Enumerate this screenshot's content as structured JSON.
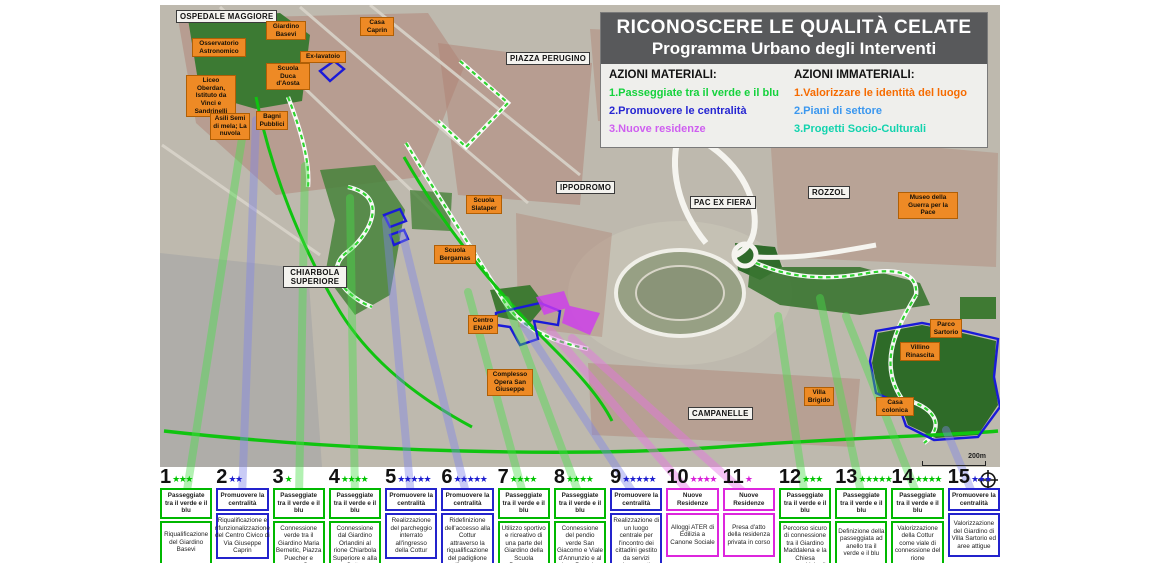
{
  "legend": {
    "title_line1": "RICONOSCERE LE QUALITÀ CELATE",
    "title_line2": "Programma Urbano degli Interventi",
    "materiali_header": "AZIONI MATERIALI:",
    "immateriali_header": "AZIONI IMMATERIALI:",
    "materiali": [
      {
        "label": "1.Passeggiate tra il verde e il blu",
        "color": "#14d23c"
      },
      {
        "label": "2.Promuovere le centralità",
        "color": "#2626d2"
      },
      {
        "label": "3.Nuove residenze",
        "color": "#cf5ff0"
      }
    ],
    "immateriali": [
      {
        "label": "1.Valorizzare le identità del luogo",
        "color": "#f66b00"
      },
      {
        "label": "2.Piani di settore",
        "color": "#3a97ef"
      },
      {
        "label": "3.Progetti Socio-Culturali",
        "color": "#12d3ae"
      }
    ]
  },
  "map": {
    "scale_label": "200m",
    "labels": [
      {
        "text": "OSPEDALE MAGGIORE",
        "kind": "place",
        "x": 176,
        "y": 10
      },
      {
        "text": "Giardino Basevi",
        "kind": "poi",
        "x": 266,
        "y": 21,
        "w": 40
      },
      {
        "text": "Casa Caprin",
        "kind": "poi",
        "x": 360,
        "y": 17,
        "w": 34
      },
      {
        "text": "Osservatorio Astronomico",
        "kind": "poi",
        "x": 192,
        "y": 38,
        "w": 54
      },
      {
        "text": "Ex-lavatoio",
        "kind": "poi",
        "x": 300,
        "y": 51,
        "w": 46
      },
      {
        "text": "Scuola Duca d'Aosta",
        "kind": "poi",
        "x": 266,
        "y": 63,
        "w": 44
      },
      {
        "text": "Liceo Oberdan, Istituto da Vinci e Sandrinelli",
        "kind": "poi",
        "x": 186,
        "y": 75,
        "w": 50
      },
      {
        "text": "Asili Semi di mela; La nuvola",
        "kind": "poi",
        "x": 210,
        "y": 113,
        "w": 40
      },
      {
        "text": "Bagni Pubblici",
        "kind": "poi",
        "x": 256,
        "y": 111,
        "w": 32
      },
      {
        "text": "PIAZZA PERUGINO",
        "kind": "place",
        "x": 506,
        "y": 52
      },
      {
        "text": "IPPODROMO",
        "kind": "place",
        "x": 556,
        "y": 181
      },
      {
        "text": "Scuola Slataper",
        "kind": "poi",
        "x": 466,
        "y": 195,
        "w": 36
      },
      {
        "text": "Scuola Bergamas",
        "kind": "poi",
        "x": 434,
        "y": 245,
        "w": 42
      },
      {
        "text": "CHIARBOLA SUPERIORE",
        "kind": "place",
        "x": 283,
        "y": 266,
        "w": 64
      },
      {
        "text": "PAC EX FIERA",
        "kind": "place",
        "x": 690,
        "y": 196
      },
      {
        "text": "ROZZOL",
        "kind": "place",
        "x": 808,
        "y": 186
      },
      {
        "text": "Museo della Guerra per la Pace",
        "kind": "poi",
        "x": 898,
        "y": 192,
        "w": 60
      },
      {
        "text": "Centro ENAIP",
        "kind": "poi",
        "x": 468,
        "y": 315,
        "w": 30
      },
      {
        "text": "Complesso Opera San Giuseppe",
        "kind": "poi",
        "x": 487,
        "y": 369,
        "w": 46
      },
      {
        "text": "Parco Sartorio",
        "kind": "poi",
        "x": 930,
        "y": 319,
        "w": 32
      },
      {
        "text": "Villino Rinascita",
        "kind": "poi",
        "x": 900,
        "y": 342,
        "w": 40
      },
      {
        "text": "Villa Brigido",
        "kind": "poi",
        "x": 804,
        "y": 387,
        "w": 30
      },
      {
        "text": "Casa colonica",
        "kind": "poi",
        "x": 876,
        "y": 397,
        "w": 38
      },
      {
        "text": "CAMPANELLE",
        "kind": "place",
        "x": 688,
        "y": 407
      }
    ]
  },
  "items": [
    {
      "number": "1",
      "stars": "★★★",
      "type": "green",
      "category": "Passeggiate tra il verde e il blu",
      "description": "Riqualificazione del Giardino Basevi"
    },
    {
      "number": "2",
      "stars": "★★",
      "type": "blue",
      "category": "Promuovere la centralità",
      "description": "Riqualificazione e rifunzionalizzazione del Centro Civico di Via Giuseppe Caprin"
    },
    {
      "number": "3",
      "stars": "★",
      "type": "green",
      "category": "Passeggiate tra il verde e il blu",
      "description": "Connessione verde tra il Giardino Maria Bernetic, Piazza Puecher e campo San Giacomo"
    },
    {
      "number": "4",
      "stars": "★★★★",
      "type": "green",
      "category": "Passeggiate tra il verde e il blu",
      "description": "Connessione dal Giardino Orlandini al rione Chiarbola Superiore e alla Cottur"
    },
    {
      "number": "5",
      "stars": "★★★★★",
      "type": "blue",
      "category": "Promuovere la centralità",
      "description": "Realizzazione del parcheggio interrato all'ingresso della Cottur"
    },
    {
      "number": "6",
      "stars": "★★★★★",
      "type": "blue",
      "category": "Promuovere la centralità",
      "description": "Ridefinizione dell'accesso alla Cottur attraverso la riqualificazione del padiglione d'ingresso"
    },
    {
      "number": "7",
      "stars": "★★★★",
      "type": "green",
      "category": "Passeggiate tra il verde e il blu",
      "description": "Utilizzo sportivo e ricreativo di una parte del Giardino della Scuola Bergamas"
    },
    {
      "number": "8",
      "stars": "★★★★",
      "type": "green",
      "category": "Passeggiate tra il verde e il blu",
      "description": "Connessione del pendio verde San Giacomo e Viale d'Annunzio e al rione Perugino"
    },
    {
      "number": "9",
      "stars": "★★★★★",
      "type": "blue",
      "category": "Promuovere la centralità",
      "description": "Realizzazione di un luogo centrale per l'incontro dei cittadini gestito da servizi impegnati nell'inserimento giovanile"
    },
    {
      "number": "10",
      "stars": "★★★★",
      "type": "magenta",
      "category": "Nuove Residenze",
      "description": "Alloggi ATER di Edilizia a Canone Sociale"
    },
    {
      "number": "11",
      "stars": "★",
      "type": "magenta",
      "category": "Nuove Residenze",
      "description": "Presa d'atto della residenza privata in corso"
    },
    {
      "number": "12",
      "stars": "★★★",
      "type": "green",
      "category": "Passeggiate tra il verde e il blu",
      "description": "Percorso sicuro di connessione tra il Giardino Maddalena e la Chiesa parrocchiale di San Marco Evangelista"
    },
    {
      "number": "13",
      "stars": "★★★★★",
      "type": "green",
      "category": "Passeggiate tra il verde e il blu",
      "description": "Definizione della passeggiata ad anello tra il verde e il blu"
    },
    {
      "number": "14",
      "stars": "★★★★",
      "type": "green",
      "category": "Passeggiate tra il verde e il blu",
      "description": "Valorizzazione della Cottur come viale di connessione del rione"
    },
    {
      "number": "15",
      "stars": "★★★",
      "type": "blue",
      "category": "Promuovere la centralità",
      "description": "Valorizzazione del Giardino di Villa Sartorio ed aree attigue"
    }
  ]
}
